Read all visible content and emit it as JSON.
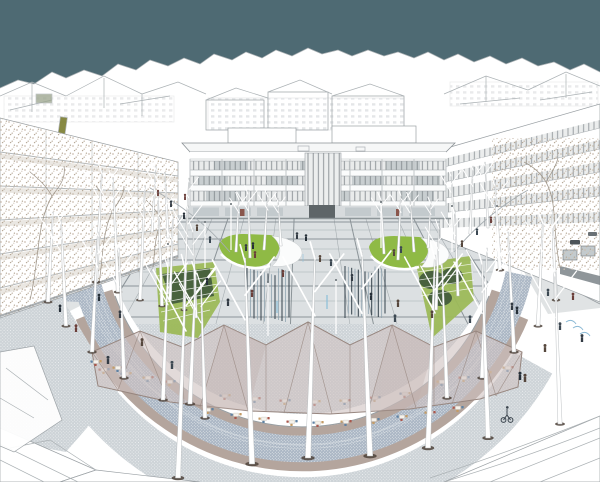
{
  "meta": {
    "label": "Aerial architectural rendering of a circular public plaza with translucent cafe canopy, birch trees, lawns and fountains",
    "type": "architectural-visualization",
    "width": 600,
    "height": 482
  },
  "colors": {
    "sky": "#4e6a73",
    "line": "#9aa0a4",
    "lineFar": "#abb1b4",
    "wall": "#ffffff",
    "plaza": "#dce0e2",
    "grid": "#a6adb1",
    "gridDark": "#7e878c",
    "lawn": "#8fba45",
    "lawnDark": "#6fa03a",
    "hedge": "#415a3c",
    "terrace": "#9cb958",
    "trunk": "#ffffff",
    "trunkEdge": "#b7bbbd",
    "treeBase": "#4d4239",
    "canopy": "#cfc2bf",
    "canopyLine": "#97867f",
    "mauve": "#b4a59d",
    "blueBand": "#a9b5c3",
    "blueDot": "#e9edf0",
    "apron": "#cdd3d7",
    "apronDot": "#f2f4f5",
    "water": "#36434d",
    "waterLight": "#8ba0ad",
    "runnel": "#8fc0da",
    "figure": "#333b44",
    "chairRed": "#a9574c",
    "chairBlue": "#5f82a3",
    "chairTan": "#c49c66",
    "table": "#f5f2ec",
    "glass": "#c3cacd",
    "band": "#e9ebeb",
    "bandDark": "#c3c9cc",
    "storefront": "#7b8488",
    "entrance": "#5e6568",
    "speckle": "#c9bdb0",
    "speckle2": "#b3a593",
    "olive": "#7b7d2f",
    "sage": "#9aa48c",
    "street": "#e0e3e4",
    "bike": "#7fb2d0"
  },
  "scene": {
    "sky": {
      "label": "overcast teal sky"
    },
    "city": {
      "label": "hidden-line white city massing"
    },
    "plaza": {
      "label": "circular plaza with paving grid",
      "lawn_islands": 2,
      "fountain_clusters": 2
    },
    "canopy": {
      "label": "translucent faceted canopy over cafe seating"
    },
    "promenade": {
      "label": "crescent promenade with dotted paving and birch rows"
    },
    "jets": [
      {
        "cx": 268,
        "w": 42,
        "top": 268,
        "bot": 322,
        "n": 13
      },
      {
        "cx": 365,
        "w": 40,
        "top": 266,
        "bot": 318,
        "n": 13
      }
    ],
    "trees_back": [
      [
        236,
        252,
        196,
        1.3,
        3,
        0
      ],
      [
        250,
        258,
        190,
        1.4,
        -2,
        0
      ],
      [
        264,
        250,
        193,
        1.3,
        4,
        0
      ],
      [
        281,
        246,
        198,
        1.2,
        -3,
        0
      ],
      [
        384,
        254,
        196,
        1.3,
        -3,
        0
      ],
      [
        398,
        260,
        192,
        1.4,
        3,
        0
      ],
      [
        414,
        252,
        196,
        1.3,
        -4,
        0
      ],
      [
        428,
        248,
        200,
        1.2,
        3,
        0
      ],
      [
        152,
        232,
        166,
        1.2,
        4,
        0
      ],
      [
        168,
        238,
        172,
        1.3,
        -3,
        0
      ],
      [
        186,
        244,
        178,
        1.2,
        3,
        0
      ],
      [
        455,
        240,
        172,
        1.2,
        -4,
        0
      ],
      [
        470,
        234,
        166,
        1.2,
        3,
        0
      ],
      [
        488,
        228,
        162,
        1.1,
        -3,
        0
      ],
      [
        96,
        282,
        170,
        1.8,
        6,
        1
      ],
      [
        118,
        292,
        178,
        1.8,
        -5,
        1
      ],
      [
        140,
        300,
        186,
        1.7,
        5,
        1
      ],
      [
        162,
        306,
        196,
        1.6,
        -4,
        1
      ],
      [
        184,
        310,
        205,
        1.5,
        4,
        1
      ],
      [
        48,
        302,
        212,
        1.9,
        5,
        1
      ],
      [
        66,
        326,
        220,
        1.9,
        -5,
        1
      ],
      [
        92,
        352,
        232,
        2,
        6,
        1
      ],
      [
        124,
        378,
        248,
        2,
        -5,
        1
      ],
      [
        163,
        400,
        264,
        2,
        5,
        1
      ],
      [
        205,
        418,
        282,
        2,
        -4,
        1
      ],
      [
        500,
        270,
        182,
        1.8,
        -5,
        1
      ],
      [
        556,
        300,
        210,
        1.8,
        -4,
        1
      ],
      [
        538,
        326,
        220,
        1.9,
        5,
        1
      ],
      [
        514,
        352,
        232,
        2,
        -6,
        1
      ],
      [
        482,
        378,
        248,
        2,
        5,
        1
      ],
      [
        447,
        398,
        264,
        2,
        -5,
        1
      ],
      [
        170,
        300,
        215,
        1.5,
        3,
        0
      ],
      [
        196,
        318,
        228,
        1.5,
        -3,
        0
      ],
      [
        436,
        310,
        225,
        1.5,
        3,
        0
      ],
      [
        458,
        296,
        210,
        1.4,
        -3,
        0
      ]
    ],
    "trees_front": [
      [
        178,
        478,
        268,
        2.6,
        8,
        1
      ],
      [
        252,
        464,
        258,
        2.8,
        -7,
        1
      ],
      [
        308,
        458,
        255,
        2.8,
        7,
        1
      ],
      [
        370,
        456,
        252,
        2.8,
        -8,
        1
      ],
      [
        428,
        448,
        255,
        2.6,
        7,
        1
      ],
      [
        488,
        438,
        260,
        2.4,
        -6,
        1
      ],
      [
        560,
        424,
        272,
        2.1,
        -5,
        1
      ],
      [
        190,
        404,
        270,
        2.2,
        6,
        1
      ]
    ],
    "poles": [
      [
        231,
        250,
        46
      ],
      [
        381,
        248,
        46
      ],
      [
        205,
        268,
        46
      ],
      [
        452,
        252,
        46
      ],
      [
        168,
        294,
        50
      ],
      [
        497,
        256,
        50
      ],
      [
        268,
        336,
        54
      ],
      [
        336,
        334,
        54
      ]
    ],
    "people": [
      [
        297,
        239
      ],
      [
        306,
        241
      ],
      [
        320,
        262
      ],
      [
        331,
        266
      ],
      [
        283,
        277
      ],
      [
        352,
        281
      ],
      [
        371,
        300
      ],
      [
        398,
        307
      ],
      [
        395,
        322
      ],
      [
        252,
        297
      ],
      [
        228,
        306
      ],
      [
        207,
        285
      ],
      [
        432,
        318
      ],
      [
        470,
        323
      ],
      [
        255,
        258
      ],
      [
        246,
        251
      ],
      [
        253,
        249
      ],
      [
        394,
        256
      ],
      [
        401,
        253
      ],
      [
        158,
        196
      ],
      [
        171,
        207
      ],
      [
        184,
        219
      ],
      [
        197,
        231
      ],
      [
        210,
        243
      ],
      [
        185,
        200
      ],
      [
        120,
        318
      ],
      [
        99,
        301
      ],
      [
        142,
        346
      ],
      [
        172,
        369
      ],
      [
        76,
        332
      ],
      [
        108,
        364
      ],
      [
        60,
        312
      ],
      [
        462,
        247
      ],
      [
        477,
        235
      ],
      [
        491,
        223
      ],
      [
        512,
        310
      ],
      [
        517,
        314
      ],
      [
        545,
        352
      ],
      [
        560,
        330
      ],
      [
        573,
        300
      ],
      [
        582,
        342
      ],
      [
        520,
        380
      ],
      [
        525,
        382
      ],
      [
        548,
        296
      ]
    ],
    "tables_front": [
      [
        208,
        410
      ],
      [
        236,
        415
      ],
      [
        264,
        419
      ],
      [
        292,
        422
      ],
      [
        318,
        423
      ],
      [
        346,
        422
      ],
      [
        374,
        420
      ],
      [
        402,
        417
      ],
      [
        430,
        413
      ],
      [
        458,
        408
      ],
      [
        96,
        362
      ],
      [
        118,
        368
      ]
    ],
    "tables_under": [
      [
        104,
        370
      ],
      [
        126,
        374
      ],
      [
        148,
        378
      ],
      [
        170,
        382
      ],
      [
        225,
        396
      ],
      [
        255,
        399
      ],
      [
        285,
        401
      ],
      [
        315,
        402
      ],
      [
        345,
        401
      ],
      [
        375,
        398
      ],
      [
        405,
        394
      ],
      [
        442,
        382
      ],
      [
        464,
        378
      ],
      [
        486,
        373
      ],
      [
        508,
        368
      ]
    ]
  }
}
